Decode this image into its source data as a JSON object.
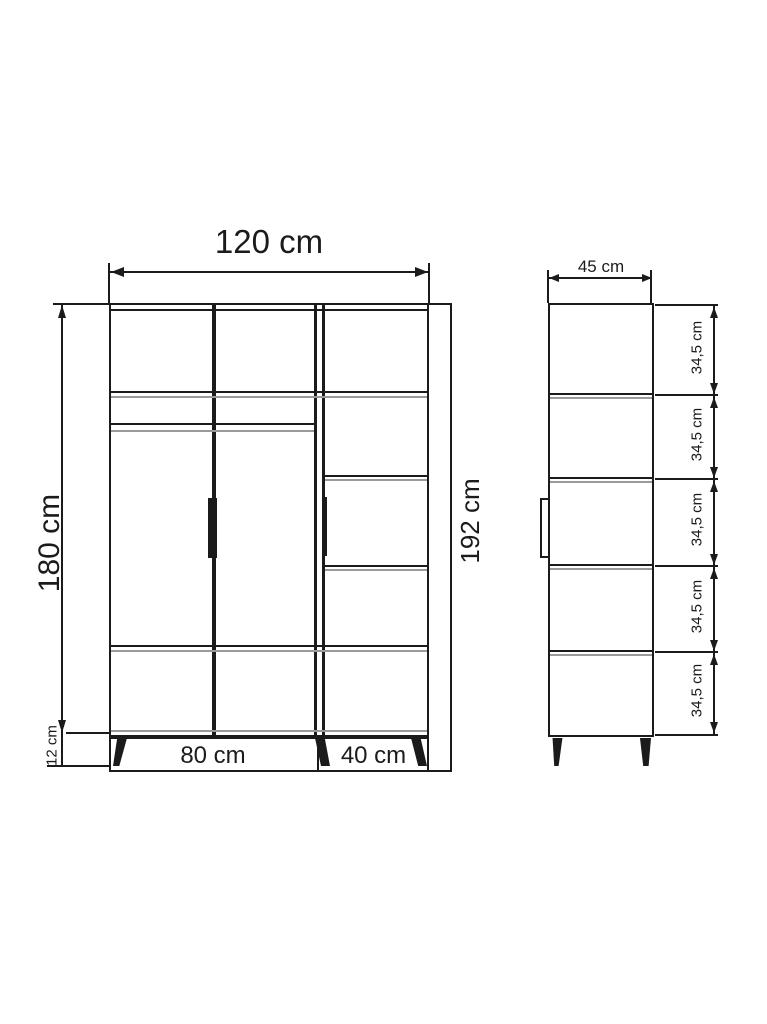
{
  "front_view": {
    "width_label": "120 cm",
    "body_height_label": "180 cm",
    "total_height_label": "192 cm",
    "leg_height_label": "12 cm",
    "left_section_label": "80 cm",
    "right_section_label": "40 cm"
  },
  "side_view": {
    "depth_label": "45 cm",
    "compartment_height_labels": [
      "34,5 cm",
      "34,5 cm",
      "34,5 cm",
      "34,5 cm",
      "34,5 cm"
    ]
  },
  "colors": {
    "line": "#1b1b1b",
    "secondary_line": "#9a9a9a",
    "background": "#ffffff"
  }
}
